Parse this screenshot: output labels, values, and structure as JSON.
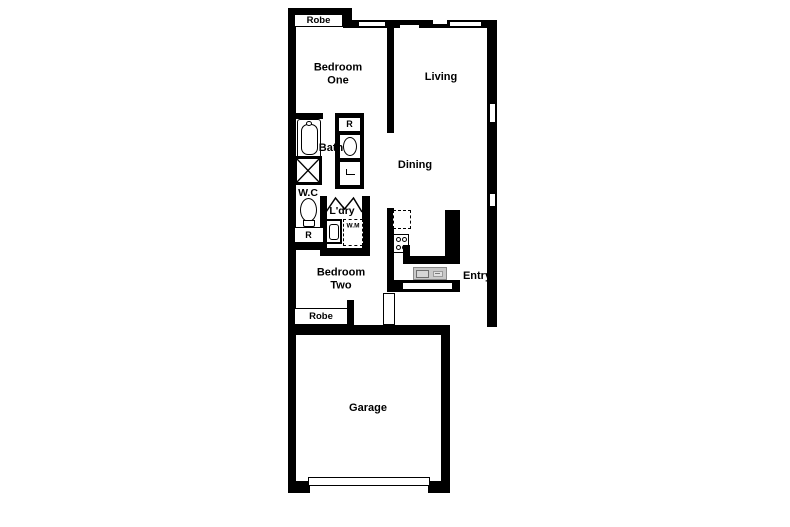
{
  "plan_title": "Two bedroom floor plan",
  "colors": {
    "wall": "#000000",
    "background": "#ffffff",
    "sink_fill": "#c9c9c9"
  },
  "rooms": {
    "bedroom_one": "Bedroom\nOne",
    "living": "Living",
    "dining": "Dining",
    "bath": "Bath",
    "wc": "W.C",
    "laundry": "L'dry",
    "bedroom_two": "Bedroom\nTwo",
    "entry": "Entry",
    "garage": "Garage"
  },
  "fixtures": {
    "robe_top": "Robe",
    "robe_bottom": "Robe",
    "robe_cupboard_bath": "R",
    "robe_cupboard_wc": "R",
    "washing_machine": "W.M"
  }
}
